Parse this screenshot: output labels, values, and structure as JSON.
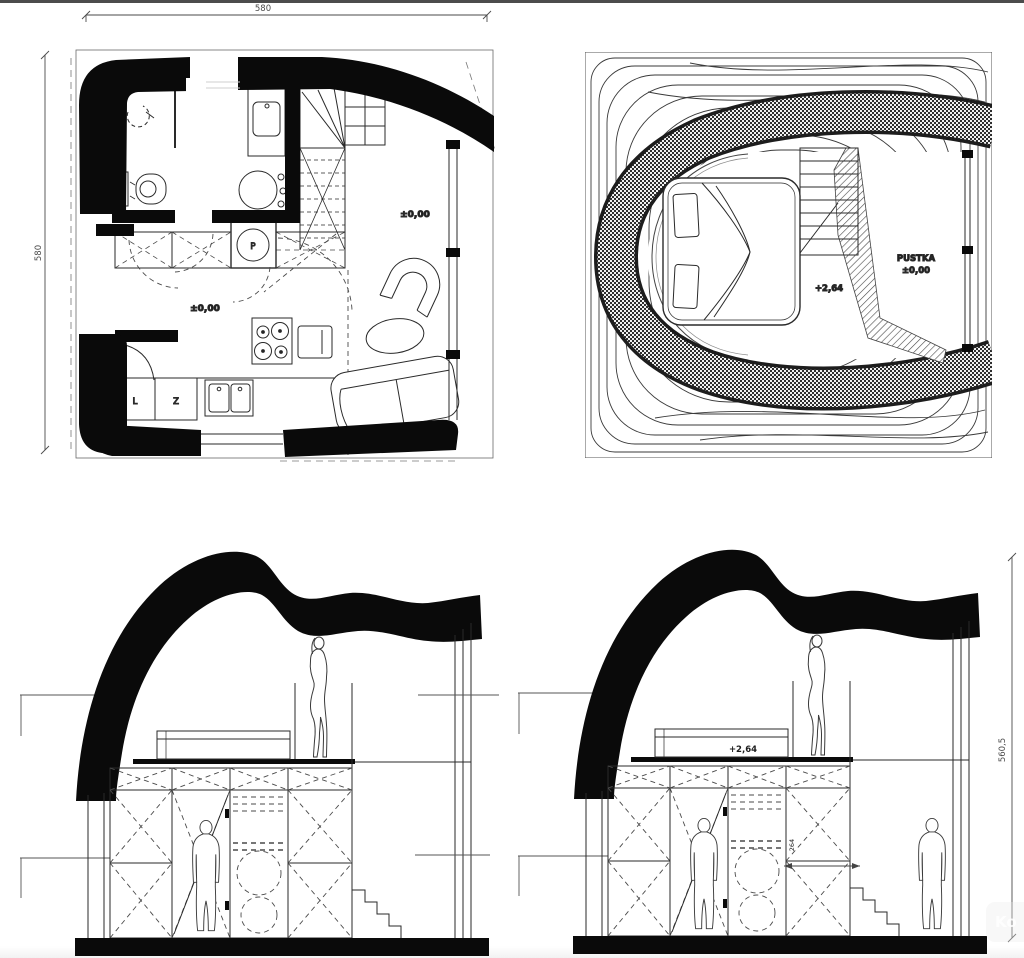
{
  "sheet": {
    "type": "architectural-drawing",
    "line_color": "#222222",
    "wall_color": "#0a0a0a"
  },
  "ground_plan": {
    "dim_width": "580",
    "dim_depth": "580",
    "level_living": "±0,00",
    "level_kitchen": "±0,00",
    "washer_label": "P",
    "cabinet_left_label": "L",
    "cabinet_right_label": "Z"
  },
  "mezzanine_plan": {
    "level_label": "+2,64",
    "void_label": "PUSTKA",
    "void_level": "±0,00"
  },
  "section_right": {
    "mezzanine_level": "+2,64",
    "room_height": "264",
    "overall_height": "560,5"
  },
  "watermark": "Ko"
}
